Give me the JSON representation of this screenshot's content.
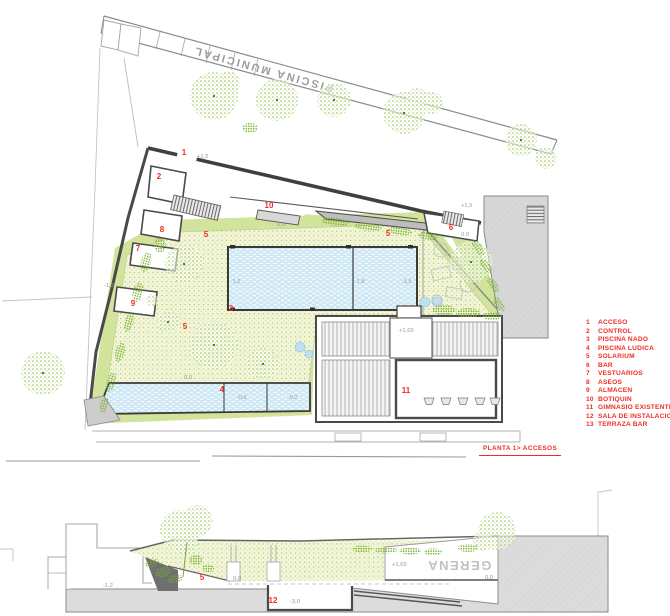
{
  "colors": {
    "accent_red": "#ee2e24",
    "lawn_green": "#a3c74b",
    "band_green": "#d2e39c",
    "pool_blue": "#cfe8f6",
    "tree_green": "#8abc3a",
    "wall_gray": "#3f3f3f",
    "ground_gray": "#dcdcdc"
  },
  "site_label": {
    "street_band": "PISCINA MUNICIPAL"
  },
  "caption": {
    "text": "PLANTA 1> ACCESOS"
  },
  "legend": {
    "items": [
      {
        "num": "1",
        "label": "ACCESO"
      },
      {
        "num": "2",
        "label": "CONTROL"
      },
      {
        "num": "3",
        "label": "PISCINA NADO"
      },
      {
        "num": "4",
        "label": "PISCINA LUDICA"
      },
      {
        "num": "5",
        "label": "SOLARIUM"
      },
      {
        "num": "6",
        "label": "BAR"
      },
      {
        "num": "7",
        "label": "VESTUARIOS"
      },
      {
        "num": "8",
        "label": "ASEOS"
      },
      {
        "num": "9",
        "label": "ALMACEN"
      },
      {
        "num": "10",
        "label": "BOTIQUIN"
      },
      {
        "num": "11",
        "label": "GIMNASIO EXISTENTE"
      },
      {
        "num": "12",
        "label": "SALA DE INSTALACIONES"
      },
      {
        "num": "13",
        "label": "TERRAZA BAR"
      }
    ]
  },
  "plan": {
    "marks": {
      "acceso": "1",
      "control": "2",
      "nado": "3",
      "ludica": "4",
      "solarium_a": "5",
      "solarium_b": "5",
      "solarium_c": "5",
      "bar": "6",
      "vestuarios": "7",
      "aseos": "8",
      "almacen": "9",
      "botiquin": "10",
      "gimnasio": "11"
    },
    "levels": {
      "entrada": "+1,5",
      "calle_alta": "+1,5",
      "deck_canopy": "0,0",
      "deck_bar": "0,0",
      "oeste": "-1,2",
      "deck_sur": "0,0",
      "gimnasio": "+1,65"
    },
    "pool_nado_depths": {
      "left": "-1,2",
      "mid": "-1,8",
      "right": "-1,8"
    },
    "pool_ludica_depths": {
      "mid": "-0,6",
      "right": "-0,2"
    }
  },
  "section": {
    "marks": {
      "solarium": "5",
      "instalaciones": "12"
    },
    "levels": {
      "calle": "-1,2",
      "deck": "0,0",
      "sala": "-3,0",
      "gimnasio": "+1,65",
      "terraza": "0,0"
    },
    "sign": "GERENA"
  }
}
